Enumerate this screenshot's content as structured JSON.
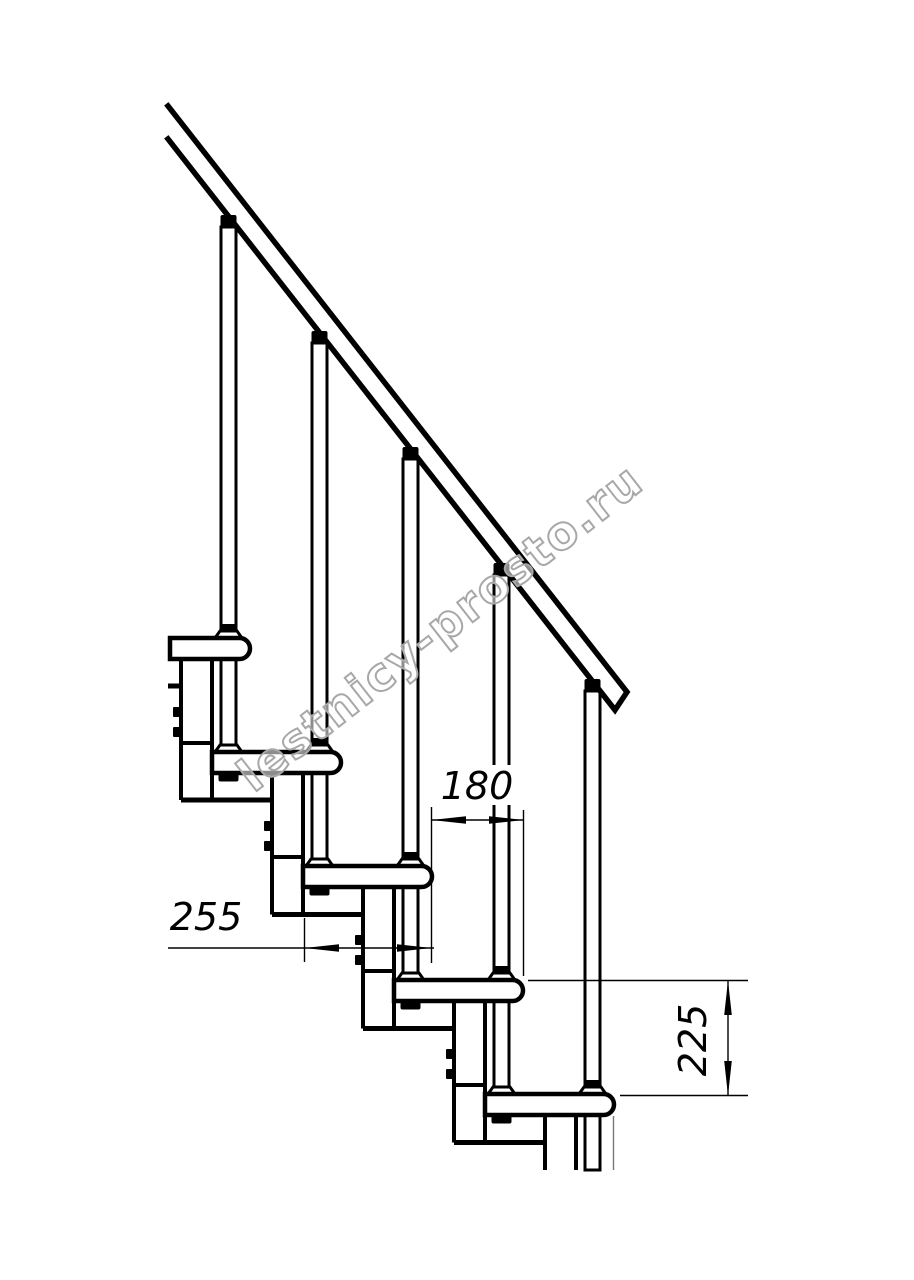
{
  "watermark": {
    "text": "lestnicy-prosto.ru",
    "color": "#a8a8a8"
  },
  "drawing": {
    "subject": "modular staircase side view",
    "background": "#ffffff",
    "line_color": "#000000",
    "dimensions": {
      "step_run": "180",
      "tread_depth": "255",
      "step_rise": "225"
    }
  }
}
